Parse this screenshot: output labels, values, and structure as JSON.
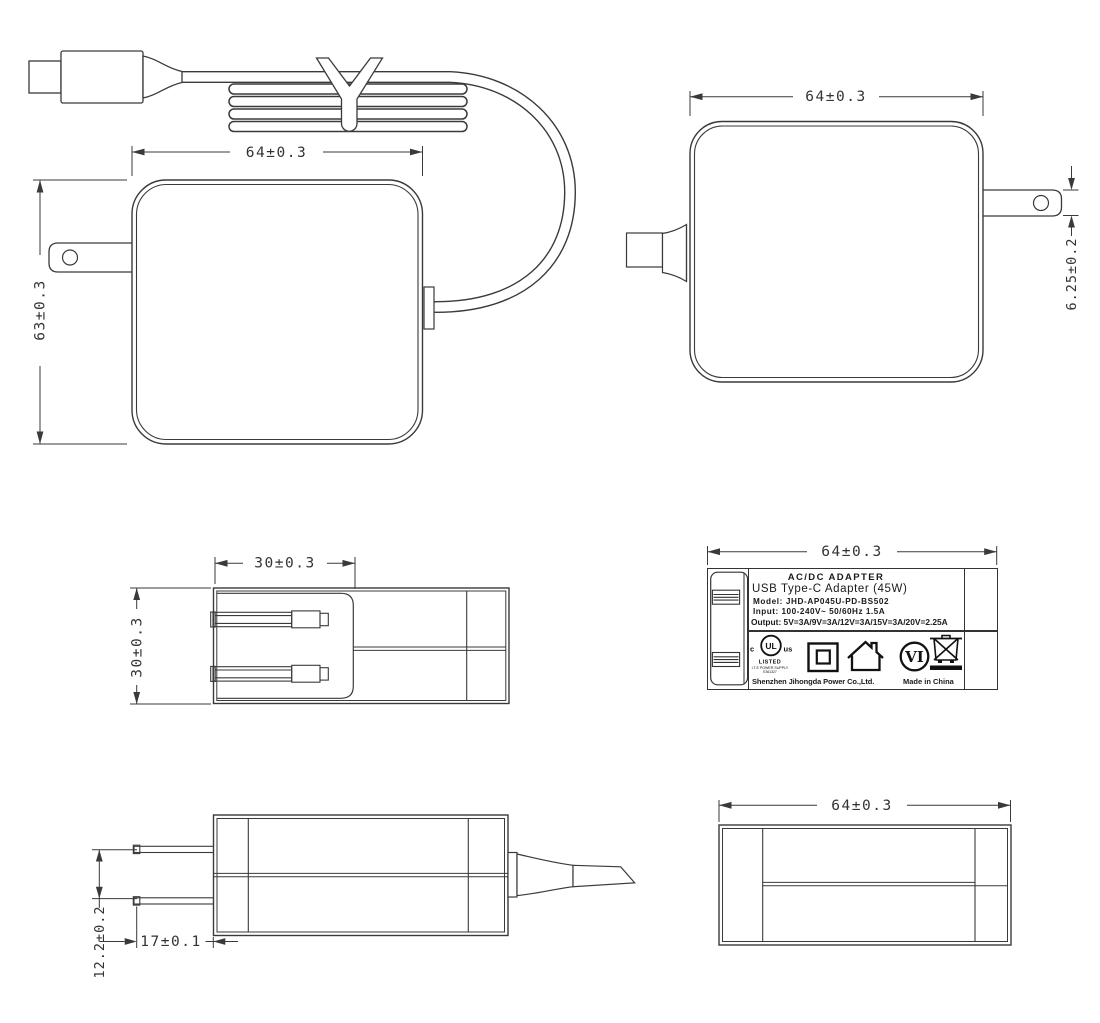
{
  "dimensions": {
    "front": {
      "width": "64±0.3",
      "height": "63±0.3"
    },
    "rear": {
      "width": "64±0.3",
      "pin_thickness": "6.25±0.2"
    },
    "top": {
      "plug_depth": "30±0.3",
      "body_thickness": "30±0.3"
    },
    "label_face": {
      "width": "64±0.3"
    },
    "side": {
      "pin_spacing": "12.2±0.2",
      "pin_length": "17±0.1"
    },
    "bottom": {
      "width": "64±0.3"
    }
  },
  "label": {
    "title": "AC/DC ADAPTER",
    "product": "USB Type-C Adapter (45W)",
    "model": "Model: JHD-AP045U-PD-BS502",
    "input": "Input: 100-240V~ 50/60Hz 1.5A",
    "output": "Output: 5V=3A/9V=3A/12V=3A/15V=3A/20V=2.25A",
    "ul_mark": {
      "prefix": "c",
      "monogram": "UL",
      "suffix": "us",
      "listed": "LISTED",
      "category": "I.T.E POWER SUPPLY",
      "file_number": "E361327"
    },
    "efficiency_level": "VI",
    "manufacturer": "Shenzhen Jihongda Power Co.,Ltd.",
    "origin": "Made in China"
  }
}
